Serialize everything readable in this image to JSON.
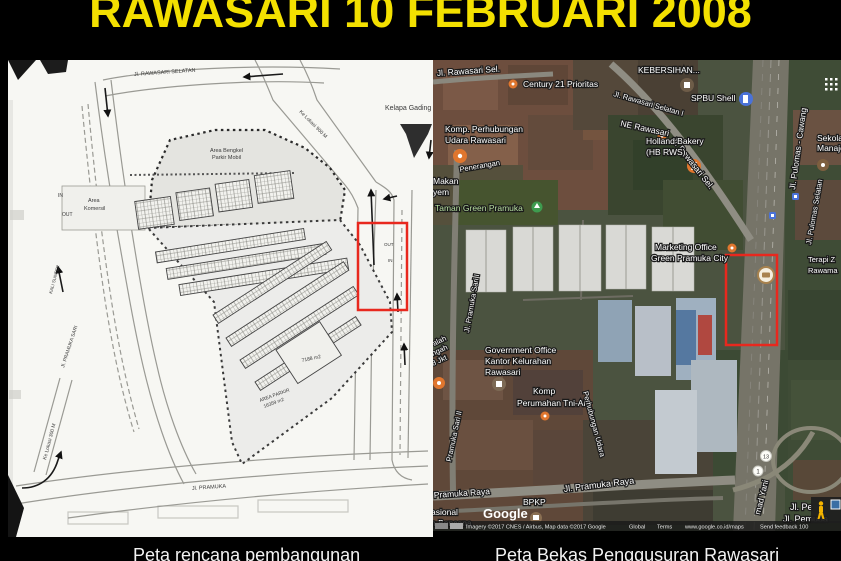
{
  "title": "RAWASARI 10 FEBRUARI 2008",
  "colors": {
    "title_yellow": "#f3e000",
    "highlight_red": "#e8281e",
    "background": "#000000"
  },
  "left_map": {
    "caption": "Peta rencana pembangunan",
    "labels": {
      "jl_rawasari_selatan": "Jl. RAWASARI SELATAN",
      "kelapa_gading": "Kelapa Gading",
      "ke_lokasi_900": "Ke Lokasi 900 M",
      "area_bengkel_line1": "Area Bengkel",
      "area_bengkel_line2": "Parkir Mobil",
      "area_komersil_line1": "Area",
      "area_komersil_line2": "Komersil",
      "in_top": "IN",
      "out_top": "OUT",
      "out_gate": "OUT",
      "in_gate": "IN",
      "blok_7188": "7188 m2",
      "area_parkir_line1": "AREA PARKIR",
      "area_parkir_line2": "16359 m2",
      "jl_pramuka": "Jl. PRAMUKA",
      "ke_lokasi_300": "Ke Lokasi 300 M",
      "jl_pramuka_sari": "Jl. PRAMUKA SARI",
      "kali_sunter": "KALI SUNTER"
    }
  },
  "right_map": {
    "caption": "Peta Bekas Penggusuran Rawasari",
    "labels": {
      "rawasari_sel_top": "Jl. Rawasari Sel.",
      "century21": "Century 21 Prioritas",
      "kebersihan": "KEBERSIHAN...",
      "spbu_shell": "SPBU Shell",
      "rawasari_selatan1": "Jl. Rawasari Selatan I",
      "rawasari_sel_diag": "Jl. Rawasari Sel.",
      "ne_rawasari": "NE Rawasari",
      "holland_line1": "Holland Bakery",
      "holland_line2": "(HB RWS)",
      "pulomas_cawang": "Jl. Pulomas - Cawang",
      "pulomas_selatan": "Jl. Pulomas Selatan",
      "sekolah_line1": "Sekola",
      "sekolah_line2": "Manaje",
      "komp_perhubungan_line1": "Komp. Perhubungan",
      "komp_perhubungan_line2": "Udara Rawasari",
      "penerangan": "Penerangan",
      "makan": "Makan",
      "yem": "yem",
      "taman_green_pramuka": "Taman Green Pramuka",
      "jl_pramuka_sari_i": "Jl. Pramuka Sari I",
      "marketing_line1": "Marketing Office",
      "marketing_line2": "Green Pramuka City",
      "terapi_line1": "Terapi Z",
      "terapi_line2": "Rawama",
      "government_line1": "Government Office",
      "government_line2": "Kantor Kelurahan",
      "government_line3": "Rawasari",
      "komp_tni_line1": "Komp",
      "komp_tni_line2": "Perumahan Tni-Al",
      "perhubungan_udara": "Perhubungan Udara",
      "alah": "alah",
      "ngah": "ngah",
      "jkt8": "8 Jkt",
      "pramuka_sari_ii": "Pramuka Sari II",
      "pramuka_raya_left": "Pramuka Raya",
      "jl_pramuka_raya": "Jl. Pramuka Raya",
      "bpkp": "BPKP",
      "asional": "asional",
      "n_bencana": "n Bencana",
      "mad_yani": "mad Yani",
      "jl_pe": "Jl. Pe",
      "jl_pemuda": "Jl. Pemuda",
      "shield_1": "1",
      "shield_13": "13"
    },
    "google_logo": "Google",
    "attribution": {
      "imagery": "Imagery ©2017 CNES / Airbus, Map data ©2017 Google",
      "global": "Global",
      "terms": "Terms",
      "maps_url": "www.google.co.id/maps",
      "send_feedback": "Send feedback",
      "scale": "100"
    }
  }
}
